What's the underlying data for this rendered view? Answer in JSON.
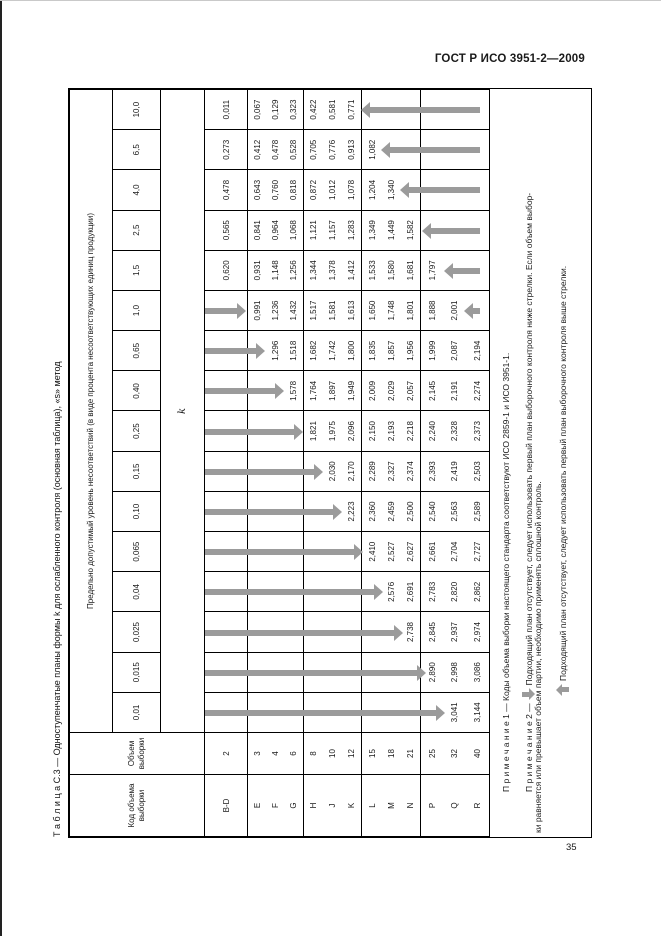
{
  "page": {
    "standard_header": "ГОСТ Р ИСО 3951-2—2009",
    "page_number": "35"
  },
  "table": {
    "title": "Т а б л и ц а   С.3 — Одноступенчатые планы формы k для ослабленного контроля (основная таблица), «s» метод",
    "headers": {
      "code_col": "Код объема выборки",
      "size_col": "Объем выборки",
      "aql_banner": "Предельно допустимый уровень несоответствий (в виде процента несоответствующих единиц продукции)",
      "k_label": "k"
    },
    "aql_values": [
      "0,01",
      "0,015",
      "0,025",
      "0,04",
      "0,065",
      "0,10",
      "0,15",
      "0,25",
      "0,40",
      "0,65",
      "1,0",
      "1,5",
      "2,5",
      "4,0",
      "6,5",
      "10,0"
    ],
    "groups": [
      {
        "codes": [
          "B-D"
        ],
        "sizes": [
          "2"
        ],
        "cells": [
          [
            ""
          ],
          [
            ""
          ],
          [
            ""
          ],
          [
            ""
          ],
          [
            ""
          ],
          [
            ""
          ],
          [
            ""
          ],
          [
            ""
          ],
          [
            ""
          ],
          [
            ""
          ],
          [
            ""
          ],
          [
            "0,620"
          ],
          [
            "0,565"
          ],
          [
            "0,478"
          ],
          [
            "0,273"
          ],
          [
            "0,011"
          ]
        ]
      },
      {
        "codes": [
          "E",
          "F",
          "G"
        ],
        "sizes": [
          "3",
          "4",
          "6"
        ],
        "cells": [
          [
            "",
            "",
            ""
          ],
          [
            "",
            "",
            ""
          ],
          [
            "",
            "",
            ""
          ],
          [
            "",
            "",
            ""
          ],
          [
            "",
            "",
            ""
          ],
          [
            "",
            "",
            ""
          ],
          [
            "",
            "",
            ""
          ],
          [
            "",
            "",
            ""
          ],
          [
            "",
            "",
            "1,578"
          ],
          [
            "",
            "1,296",
            "1,518"
          ],
          [
            "0,991",
            "1,236",
            "1,432"
          ],
          [
            "0,931",
            "1,148",
            "1,256"
          ],
          [
            "0,841",
            "0,964",
            "1,068"
          ],
          [
            "0,643",
            "0,760",
            "0,818"
          ],
          [
            "0,412",
            "0,478",
            "0,528"
          ],
          [
            "0,067",
            "0,129",
            "0,323"
          ]
        ]
      },
      {
        "codes": [
          "H",
          "J",
          "K"
        ],
        "sizes": [
          "8",
          "10",
          "12"
        ],
        "cells": [
          [
            "",
            "",
            ""
          ],
          [
            "",
            "",
            ""
          ],
          [
            "",
            "",
            ""
          ],
          [
            "",
            "",
            ""
          ],
          [
            "",
            "",
            ""
          ],
          [
            "",
            "",
            "2,223"
          ],
          [
            "",
            "2,030",
            "2,170"
          ],
          [
            "1,821",
            "1,975",
            "2,096"
          ],
          [
            "1,764",
            "1,897",
            "1,949"
          ],
          [
            "1,682",
            "1,742",
            "1,800"
          ],
          [
            "1,517",
            "1,581",
            "1,613"
          ],
          [
            "1,344",
            "1,378",
            "1,412"
          ],
          [
            "1,121",
            "1,157",
            "1,283"
          ],
          [
            "0,872",
            "1,012",
            "1,078"
          ],
          [
            "0,705",
            "0,776",
            "0,913"
          ],
          [
            "0,422",
            "0,581",
            "0,771"
          ]
        ]
      },
      {
        "codes": [
          "L",
          "M",
          "N"
        ],
        "sizes": [
          "15",
          "18",
          "21"
        ],
        "cells": [
          [
            "",
            "",
            ""
          ],
          [
            "",
            "",
            ""
          ],
          [
            "",
            "",
            "2,738"
          ],
          [
            "",
            "2,576",
            "2,691"
          ],
          [
            "2,410",
            "2,527",
            "2,627"
          ],
          [
            "2,360",
            "2,459",
            "2,500"
          ],
          [
            "2,289",
            "2,327",
            "2,374"
          ],
          [
            "2,150",
            "2,193",
            "2,218"
          ],
          [
            "2,009",
            "2,029",
            "2,057"
          ],
          [
            "1,835",
            "1,857",
            "1,956"
          ],
          [
            "1,650",
            "1,748",
            "1,801"
          ],
          [
            "1,533",
            "1,580",
            "1,681"
          ],
          [
            "1,349",
            "1,449",
            "1,582"
          ],
          [
            "1,204",
            "1,340",
            ""
          ],
          [
            "1,082",
            "",
            ""
          ],
          [
            "",
            "",
            ""
          ]
        ]
      },
      {
        "codes": [
          "P",
          "Q",
          "R"
        ],
        "sizes": [
          "25",
          "32",
          "40"
        ],
        "cells": [
          [
            "",
            "3,041",
            "3,144"
          ],
          [
            "2,890",
            "2,998",
            "3,086"
          ],
          [
            "2,845",
            "2,937",
            "2,974"
          ],
          [
            "2,783",
            "2,820",
            "2,862"
          ],
          [
            "2,661",
            "2,704",
            "2,727"
          ],
          [
            "2,540",
            "2,563",
            "2,589"
          ],
          [
            "2,393",
            "2,419",
            "2,503"
          ],
          [
            "2,240",
            "2,328",
            "2,373"
          ],
          [
            "2,145",
            "2,191",
            "2,274"
          ],
          [
            "1,999",
            "2,087",
            "2,194"
          ],
          [
            "1,888",
            "2,001",
            ""
          ],
          [
            "1,797",
            "",
            ""
          ],
          [
            "",
            "",
            ""
          ],
          [
            "",
            "",
            ""
          ],
          [
            "",
            "",
            ""
          ],
          [
            "",
            "",
            ""
          ]
        ]
      }
    ]
  },
  "arrows": {
    "down": [
      {
        "aql": "0,01",
        "tip_at": "Q"
      },
      {
        "aql": "0,015",
        "tip_at": "P"
      },
      {
        "aql": "0,025",
        "tip_at": "N"
      },
      {
        "aql": "0,04",
        "tip_at": "M"
      },
      {
        "aql": "0,065",
        "tip_at": "L"
      },
      {
        "aql": "0,10",
        "tip_at": "K"
      },
      {
        "aql": "0,15",
        "tip_at": "J"
      },
      {
        "aql": "0,25",
        "tip_at": "H"
      },
      {
        "aql": "0,40",
        "tip_at": "G"
      },
      {
        "aql": "0,65",
        "tip_at": "F"
      },
      {
        "aql": "1,0",
        "tip_at": "E"
      }
    ],
    "up": [
      {
        "aql": "1,0",
        "tip_at": "R"
      },
      {
        "aql": "1,5",
        "tip_at": "Q"
      },
      {
        "aql": "2,5",
        "tip_at": "P"
      },
      {
        "aql": "4,0",
        "tip_at": "N"
      },
      {
        "aql": "6,5",
        "tip_at": "M"
      },
      {
        "aql": "10,0",
        "tip_at": "L"
      }
    ]
  },
  "notes": {
    "line1": "П р и м е ч а н и е  1 — Коды объема выборки настоящего стандарта соответствуют ИСО 2859-1 и ИСО 3951-1.",
    "line2_prefix": "П р и м е ч а н и е  2 —",
    "line2_text": "Подходящий план отсутствует, следует использовать первый план выборочного контроля ниже стрелки. Если объем выбор-",
    "line3": "ки равняется или превышает объем партии, необходимо применять сплошной контроль.",
    "line4_text": "Подходящий план отсутствует, следует использовать первый план выборочного контроля выше стрелки."
  },
  "colors": {
    "arrow": "#9b9b9b",
    "border": "#000000",
    "paper": "#ffffff"
  }
}
